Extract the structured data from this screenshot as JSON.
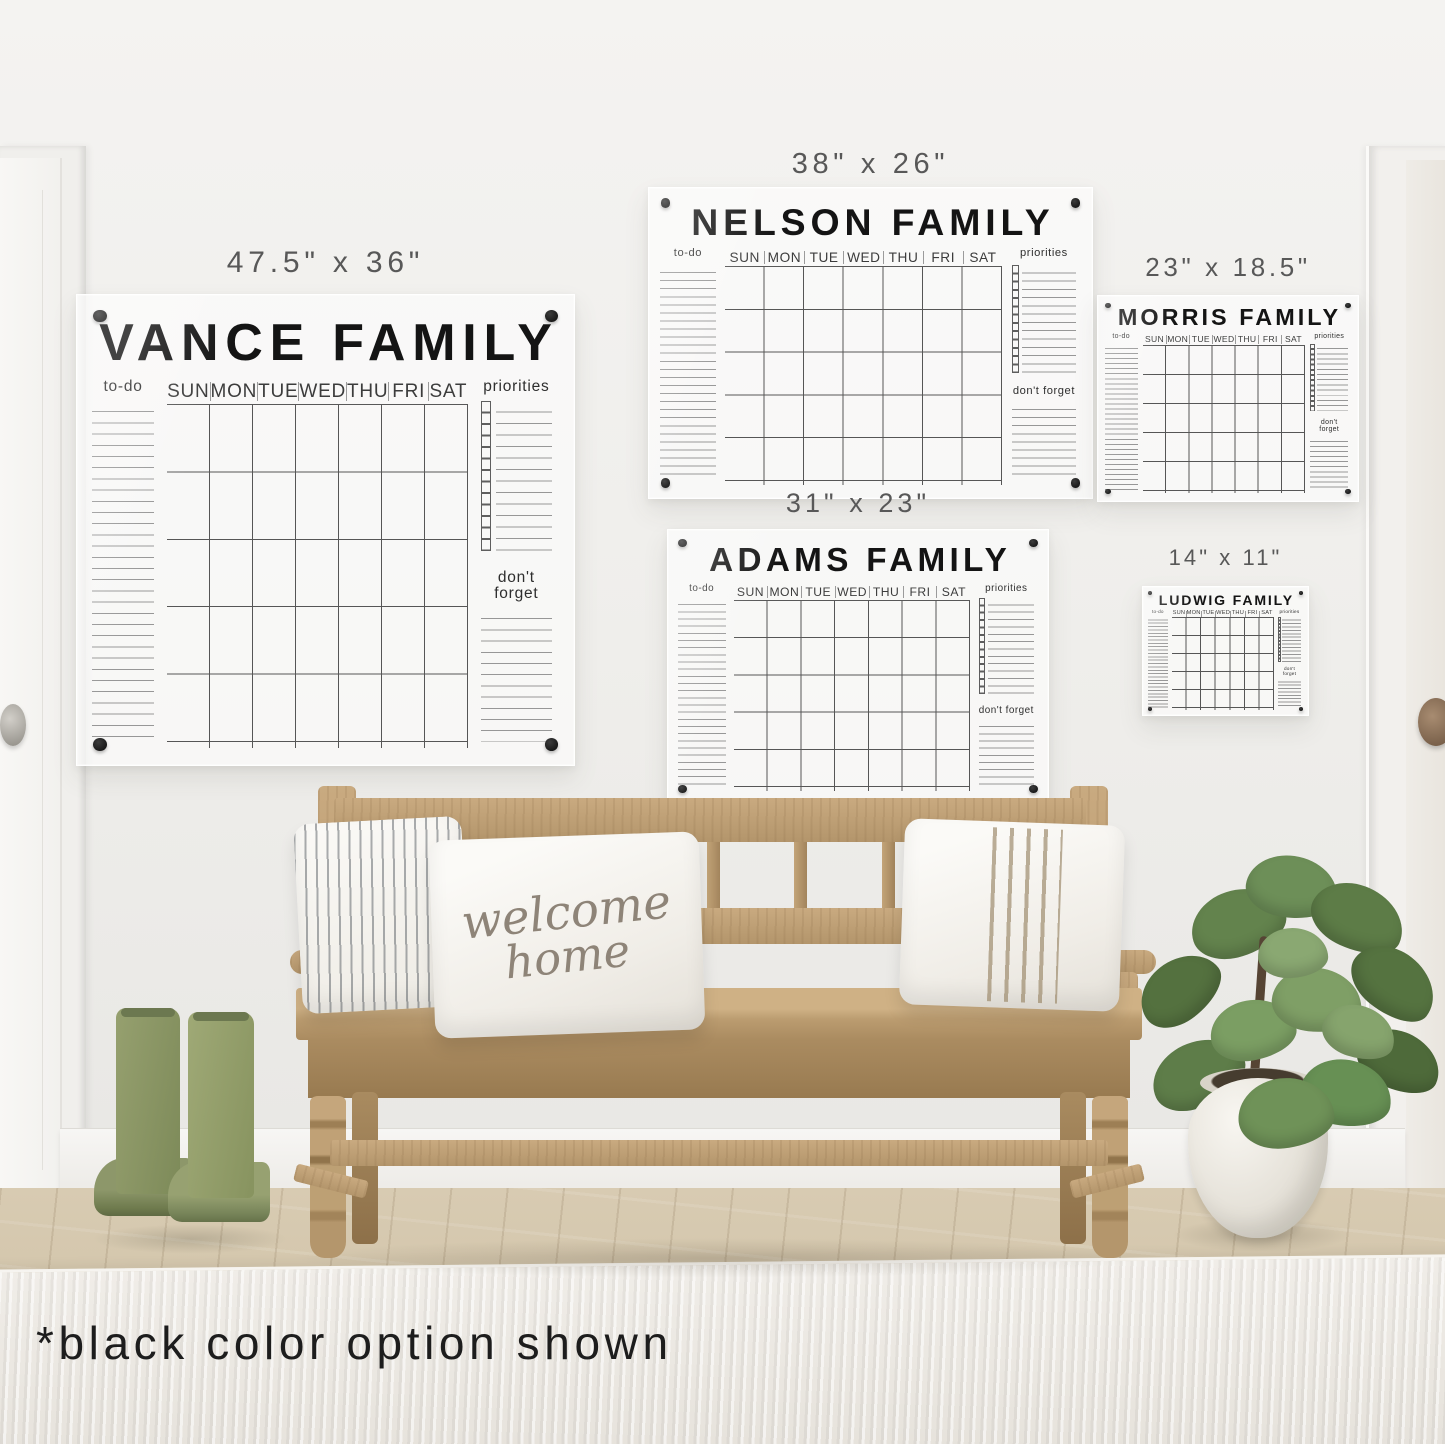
{
  "footnote": "*black color option shown",
  "labels": {
    "todo": "to-do",
    "priorities": "priorities",
    "dont_forget": "don't forget",
    "days": [
      "SUN",
      "MON",
      "TUE",
      "WED",
      "THU",
      "FRI",
      "SAT"
    ]
  },
  "boards": {
    "vance": {
      "size": "47.5\" x 36\"",
      "name": "VANCE FAMILY"
    },
    "nelson": {
      "size": "38\" x 26\"",
      "name": "NELSON FAMILY"
    },
    "morris": {
      "size": "23\" x 18.5\"",
      "name": "MORRIS FAMILY"
    },
    "adams": {
      "size": "31\" x 23\"",
      "name": "ADAMS FAMILY"
    },
    "ludwig": {
      "size": "14\" x 11\"",
      "name": "LUDWIG FAMILY"
    }
  },
  "pillow": {
    "line1": "welcome",
    "line2": "home"
  },
  "colors": {
    "marker_option": "#111111",
    "mount_dot": "#0d0d0d",
    "wall": "#efeeeb",
    "wood": "#bda27a",
    "floor": "#d5c8ae",
    "boots": "#8f9a6d",
    "plant": "#5f7d49",
    "pillow_script": "#8e8478"
  }
}
